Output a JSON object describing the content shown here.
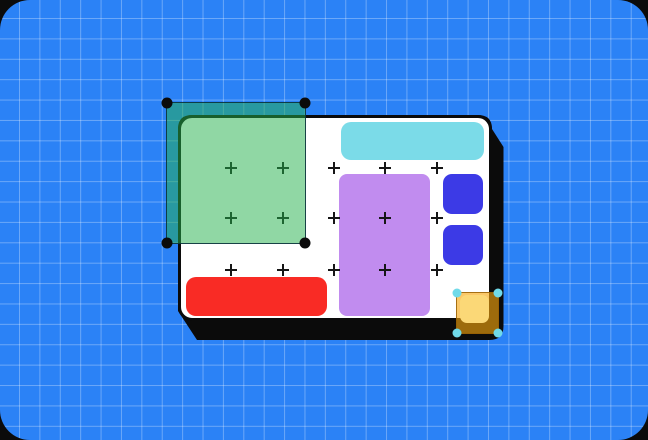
{
  "colors": {
    "page_ink": "#0B0B0B",
    "canvas_blue": "#2B82F6",
    "grid_line": "rgba(255,255,255,0.30)",
    "artboard_white": "#FFFFFF",
    "border_ink": "#0B0B0B",
    "shadow_ink": "#0B0B0B",
    "cyan_bar": "#7BDBE8",
    "purple_rect": "#C18CEF",
    "blue_square": "#3C3AE6",
    "red_bar": "#F92B25",
    "yellow_sticker": "#FBD877",
    "plus_mark": "#161616",
    "green_selection_fill": "rgba(37,176,76,0.51)",
    "green_selection_stroke": "rgba(10,50,60,0.9)",
    "green_handle": "#0B0B0B",
    "orange_selection_fill": "rgba(247,166,13,0.62)",
    "orange_selection_stroke": "rgba(150,95,5,0.85)",
    "cyan_handle": "#70DAE9"
  },
  "plus_grid": {
    "columns_x": [
      231,
      283,
      334,
      385,
      437
    ],
    "rows_y": [
      168,
      218,
      270
    ]
  },
  "selections": {
    "green": {
      "handle_icon": "corner-handle-icon",
      "handle_color_key": "green_handle",
      "handle_size_px": 11
    },
    "orange": {
      "handle_icon": "corner-handle-icon",
      "handle_color_key": "cyan_handle",
      "handle_size_px": 9
    }
  },
  "shapes": [
    {
      "name": "artboard",
      "color_key": "artboard_white"
    },
    {
      "name": "cyan-bar",
      "color_key": "cyan_bar"
    },
    {
      "name": "purple-rect",
      "color_key": "purple_rect"
    },
    {
      "name": "blue-square-top",
      "color_key": "blue_square"
    },
    {
      "name": "blue-square-bottom",
      "color_key": "blue_square"
    },
    {
      "name": "red-bar",
      "color_key": "red_bar"
    },
    {
      "name": "yellow-sticker",
      "color_key": "yellow_sticker"
    }
  ]
}
